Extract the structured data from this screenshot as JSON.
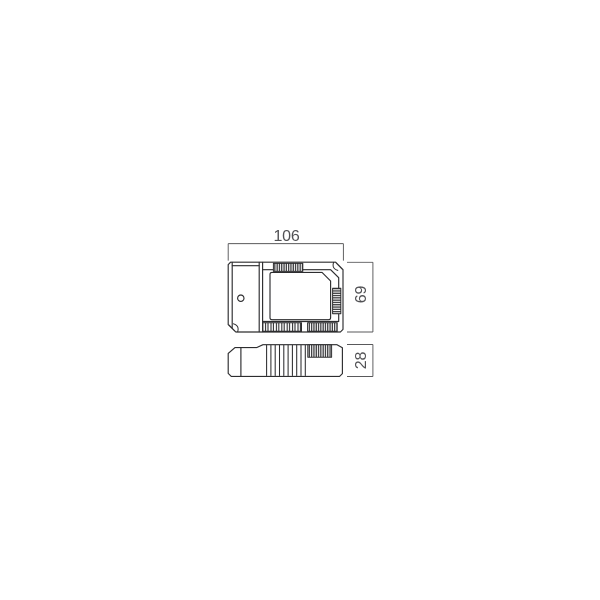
{
  "diagram": {
    "dimensions": {
      "width": {
        "label": "106"
      },
      "height": {
        "label": "69"
      },
      "depth": {
        "label": "28"
      }
    },
    "colors": {
      "outline": "#2d2d2f",
      "dimension": "#59595b",
      "label_text": "#515154",
      "background": "#ffffff"
    }
  }
}
